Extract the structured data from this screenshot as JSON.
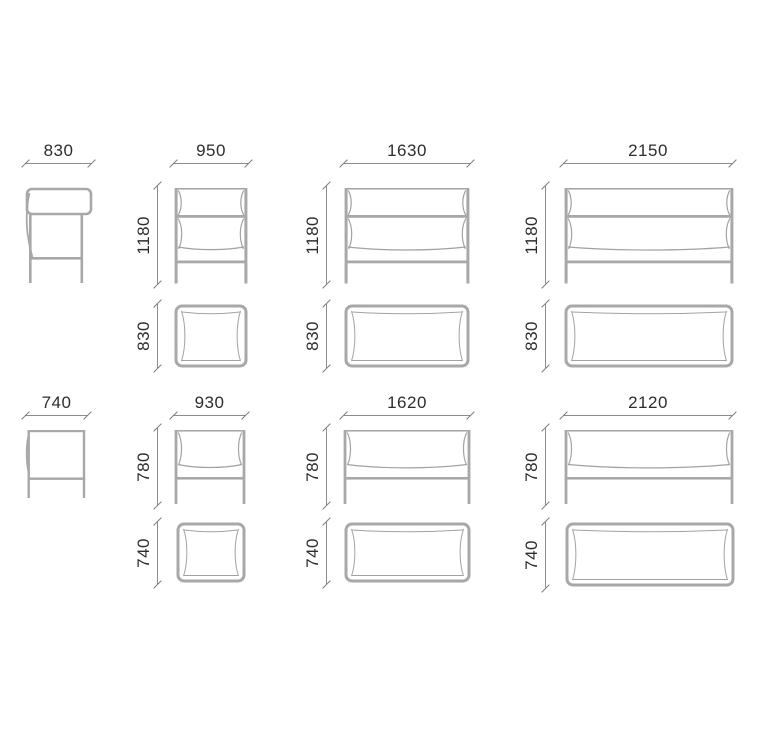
{
  "sheet": {
    "high_series": {
      "side_width": "830",
      "armchair_width": "950",
      "loveseat_width": "1630",
      "sofa_width": "2150",
      "height": "1180",
      "depth": "830"
    },
    "low_series": {
      "side_width": "740",
      "armchair_width": "930",
      "loveseat_width": "1620",
      "sofa_width": "2120",
      "height": "780",
      "depth": "740"
    },
    "colors": {
      "background": "#ffffff",
      "drawing_line": "#a8a8a8",
      "dimension_line": "#8c8c8c",
      "dimension_text": "#2d2d2d"
    }
  }
}
